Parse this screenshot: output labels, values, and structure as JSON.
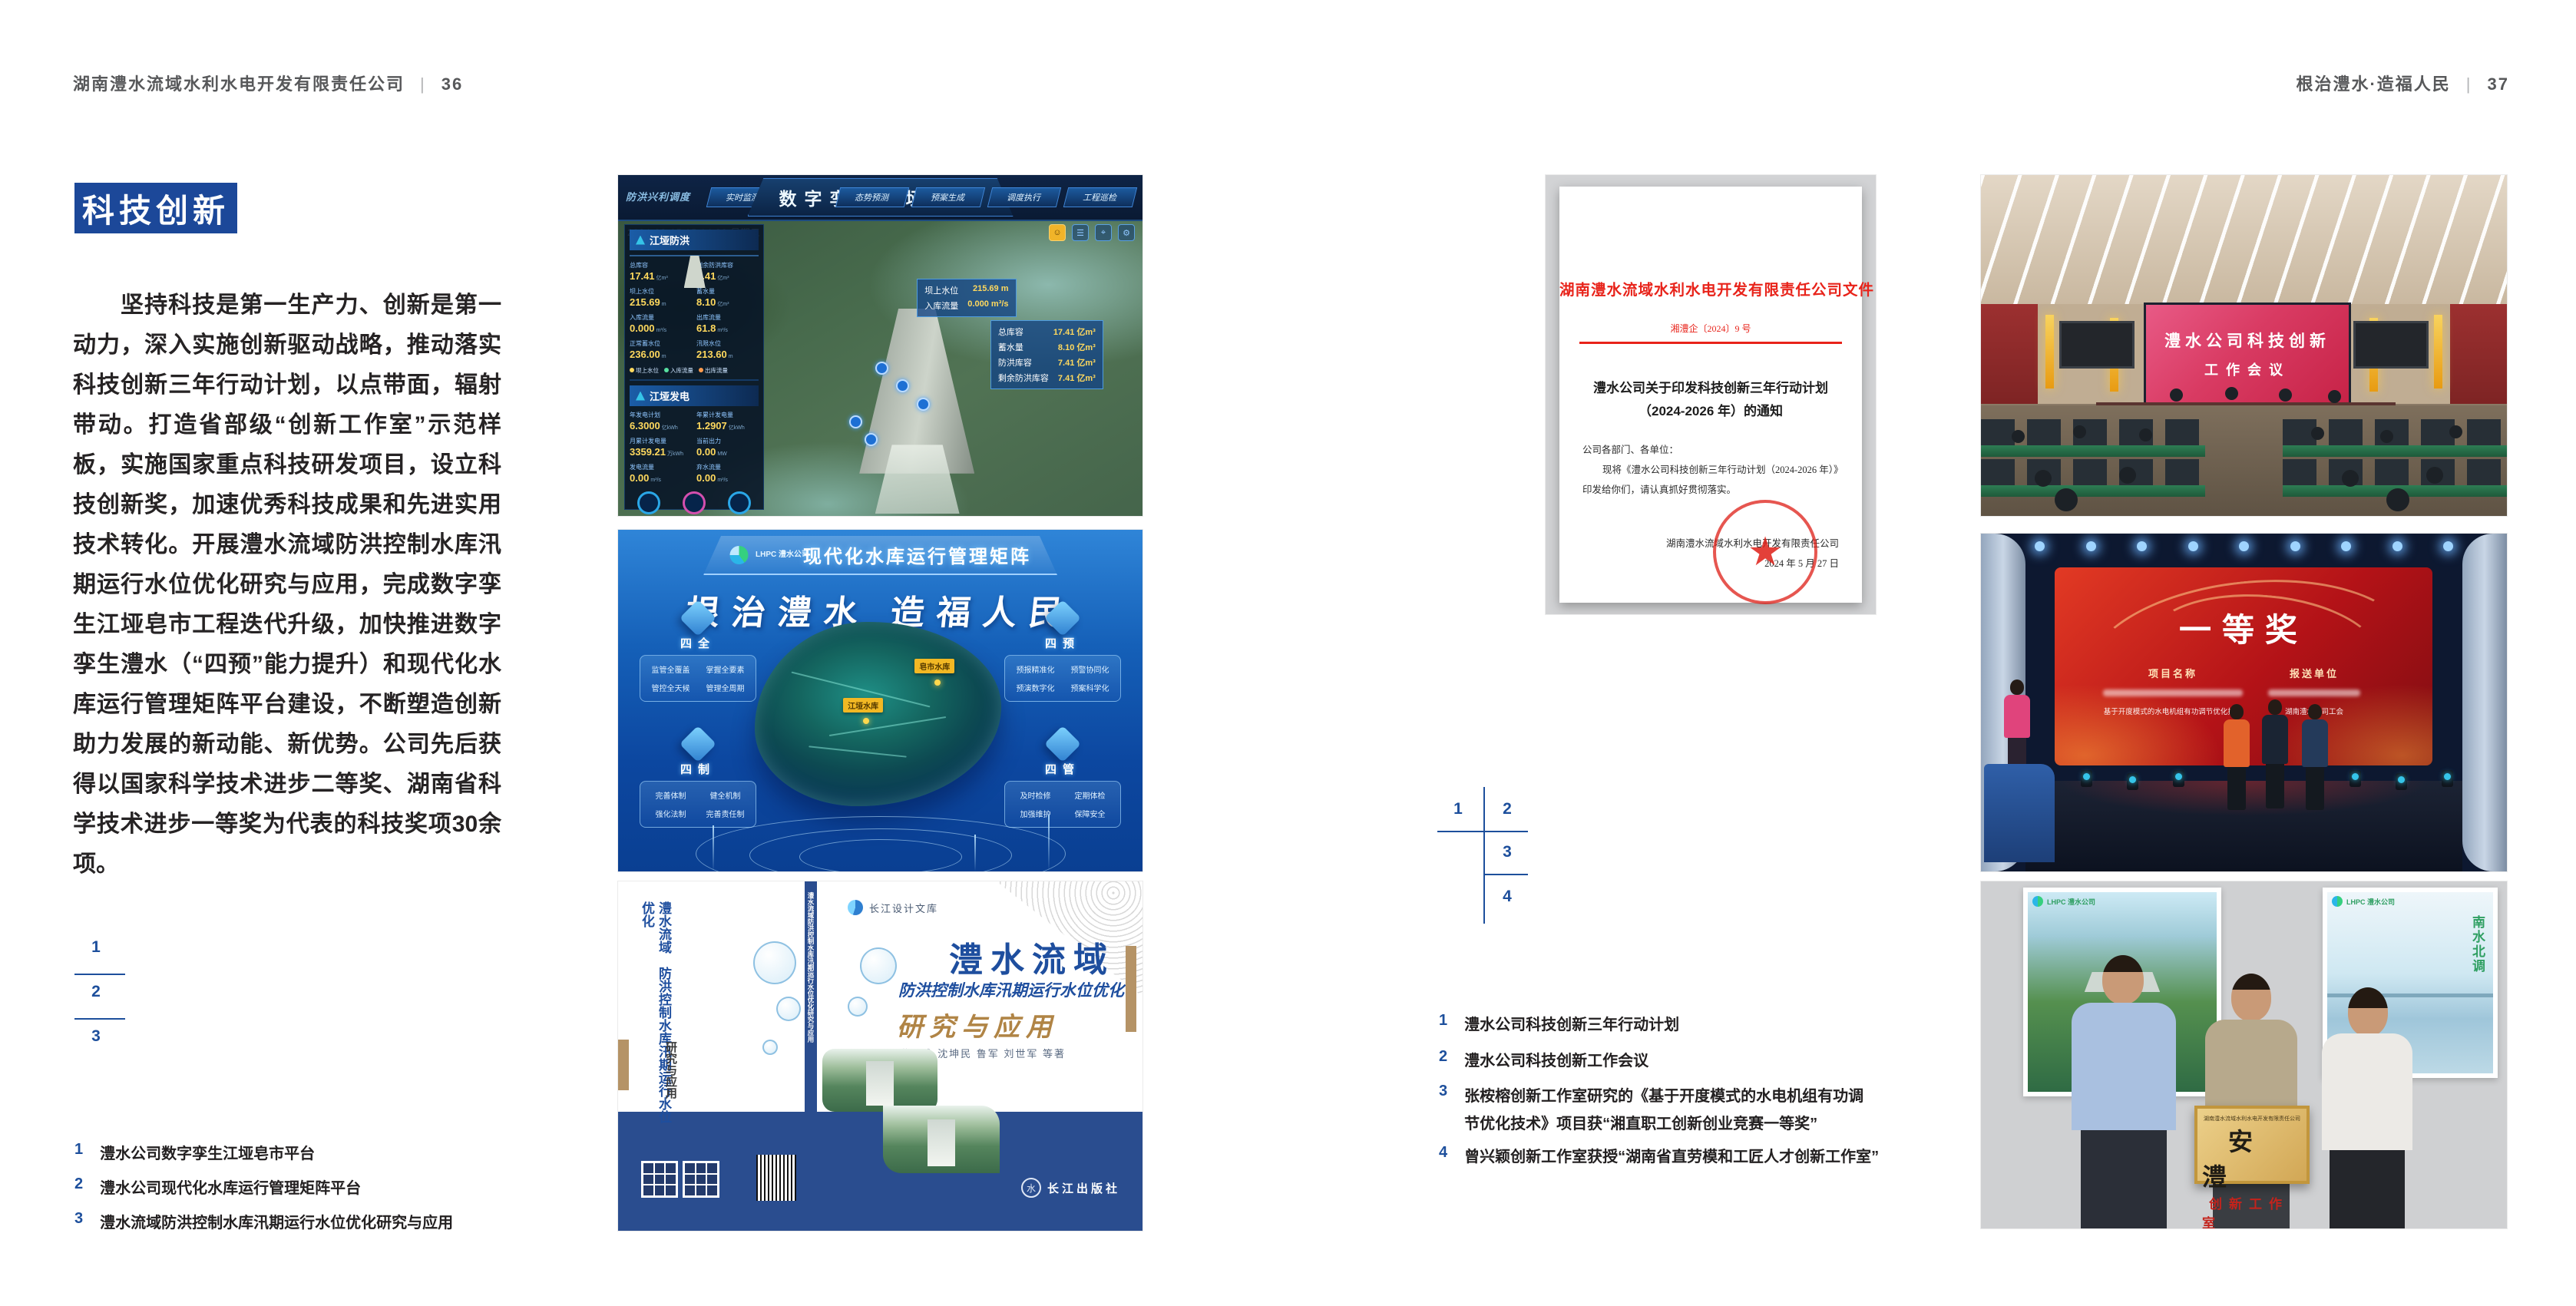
{
  "page_left": {
    "header": {
      "company": "湖南澧水流域水利水电开发有限责任公司",
      "divider": "|",
      "page_no": "36"
    },
    "section_title": "科技创新",
    "paragraph": "坚持科技是第一生产力、创新是第一动力，深入实施创新驱动战略，推动落实科技创新三年行动计划，以点带面，辐射带动。打造省部级“创新工作室”示范样板，实施国家重点科技研发项目，设立科技创新奖，加速优秀科技成果和先进实用技术转化。开展澧水流域防洪控制水库汛期运行水位优化研究与应用，完成数字孪生江垭皂市工程迭代升级，加快推进数字孪生澧水（“四预”能力提升）和现代化水库运行管理矩阵平台建设，不断塑造创新助力发展的新动能、新优势。公司先后获得以国家科学技术进步二等奖、湖南省科学技术进步一等奖为代表的科技奖项30余项。",
    "figure_index": [
      "1",
      "2",
      "3"
    ],
    "captions": [
      {
        "num": "1",
        "text": "澧水公司数字孪生江垭皂市平台"
      },
      {
        "num": "2",
        "text": "澧水公司现代化水库运行管理矩阵平台"
      },
      {
        "num": "3",
        "text": "澧水流域防洪控制水库汛期运行水位优化研究与应用"
      }
    ]
  },
  "dashboard": {
    "title": "数字孪生江垭皂市",
    "mode_label": "防洪兴利调度",
    "tabs_left": [
      "实时监测",
      "洪水预报",
      "防洪预警"
    ],
    "tabs_right": [
      "态势预测",
      "预案生成",
      "调度执行",
      "工程巡检"
    ],
    "timestamp": "2024-03-15 15:14:38 星期五",
    "flood": {
      "title": "江垭防洪",
      "stats": [
        {
          "label": "总库容",
          "value": "17.41",
          "unit": "亿m³"
        },
        {
          "label": "剩余防洪库容",
          "value": "7.41",
          "unit": "亿m³"
        },
        {
          "label": "坝上水位",
          "value": "215.69",
          "unit": "m"
        },
        {
          "label": "蓄水量",
          "value": "8.10",
          "unit": "亿m³"
        },
        {
          "label": "入库流量",
          "value": "0.000",
          "unit": "m³/s"
        },
        {
          "label": "出库流量",
          "value": "61.8",
          "unit": "m³/s"
        },
        {
          "label": "正常蓄水位",
          "value": "236.00",
          "unit": "m"
        },
        {
          "label": "汛限水位",
          "value": "213.60",
          "unit": "m"
        }
      ],
      "legend": [
        "坝上水位",
        "入库流量",
        "出库流量"
      ]
    },
    "power": {
      "title": "江垭发电",
      "stats": [
        {
          "label": "年发电计划",
          "value": "6.3000",
          "unit": "亿kWh"
        },
        {
          "label": "年累计发电量",
          "value": "1.2907",
          "unit": "亿kWh"
        },
        {
          "label": "月累计发电量",
          "value": "3359.21",
          "unit": "万kWh"
        },
        {
          "label": "当前出力",
          "value": "0.00",
          "unit": "MW"
        },
        {
          "label": "发电流量",
          "value": "0.00",
          "unit": "m³/s"
        },
        {
          "label": "弃水流量",
          "value": "0.00",
          "unit": "m³/s"
        }
      ]
    },
    "chip_dam": {
      "rows": [
        {
          "l": "坝上水位",
          "v": "215.69 m"
        },
        {
          "l": "入库流量",
          "v": "0.000 m³/s"
        }
      ]
    },
    "chip_storage": {
      "rows": [
        {
          "l": "总库容",
          "v": "17.41 亿m³"
        },
        {
          "l": "蓄水量",
          "v": "8.10 亿m³"
        },
        {
          "l": "防洪库容",
          "v": "7.41 亿m³"
        },
        {
          "l": "剩余防洪库容",
          "v": "7.41 亿m³"
        }
      ]
    }
  },
  "platform": {
    "brand": "LHPC 澧水公司",
    "title": "现代化水库运行管理矩阵",
    "slogan": "根治澧水 造福人民",
    "panels": [
      {
        "title": "四全",
        "items": [
          "监管全覆盖",
          "掌握全要素",
          "管控全天候",
          "管理全周期"
        ]
      },
      {
        "title": "四预",
        "items": [
          "预报精准化",
          "预警协同化",
          "预演数字化",
          "预案科学化"
        ]
      },
      {
        "title": "四制",
        "items": [
          "完善体制",
          "健全机制",
          "强化法制",
          "完善责任制"
        ]
      },
      {
        "title": "四管",
        "items": [
          "及时检修",
          "定期体检",
          "加强维护",
          "保障安全"
        ]
      }
    ],
    "map_labels": [
      "江垭水库",
      "皂市水库"
    ]
  },
  "book": {
    "series": "长江设计文库",
    "title_main": "澧水流域",
    "title_sub": "防洪控制水库汛期运行水位优化",
    "title_tail": "研究与应用",
    "authors": "洪兴骏 沈坤民 鲁军 刘世军 等著",
    "publisher": "长江出版社",
    "spine_title": "澧水流域防洪控制水库汛期运行水位优化研究与应用",
    "back_line1": "澧水流域",
    "back_line2": "防洪控制水库汛期运行水位优化",
    "back_line3": "研究与应用"
  },
  "page_right": {
    "header": {
      "slogan": "根治澧水·造福人民",
      "divider": "|",
      "page_no": "37"
    },
    "figure_index": [
      "1",
      "2",
      "3",
      "4"
    ],
    "captions": [
      {
        "num": "1",
        "text": "澧水公司科技创新三年行动计划"
      },
      {
        "num": "2",
        "text": "澧水公司科技创新工作会议"
      },
      {
        "num": "3",
        "text": "张桉榕创新工作室研究的《基于开度模式的水电机组有功调节优化技术》项目获“湘直职工创新创业竞赛一等奖”"
      },
      {
        "num": "4",
        "text": "曾兴颖创新工作室获授“湖南省直劳模和工匠人才创新工作室”"
      }
    ]
  },
  "document": {
    "org_banner": "湖南澧水流域水利水电开发有限责任公司文件",
    "doc_no": "湘澧企〔2024〕9 号",
    "title_line1": "澧水公司关于印发科技创新三年行动计划",
    "title_line2": "（2024-2026 年）的通知",
    "salutation": "公司各部门、各单位：",
    "body": "现将《澧水公司科技创新三年行动计划（2024-2026 年）》印发给你们，请认真抓好贯彻落实。",
    "signer": "湖南澧水流域水利水电开发有限责任公司",
    "date": "2024 年 5 月 27 日"
  },
  "meeting": {
    "screen_line1": "澧水公司科技创新",
    "screen_line2": "工作会议"
  },
  "award": {
    "title": "一等奖",
    "col_project": "项目名称",
    "col_unit": "报送单位",
    "project_2": "基于开度模式的水电机组有功调节优化技术",
    "unit_2": "湖南澧水公司工会"
  },
  "group_photo": {
    "poster_logo": "LHPC 澧水公司",
    "poster_right_text": "南水北调",
    "plaque_org": "湖南澧水流域水利水电开发有限责任公司",
    "plaque_name": "安澧",
    "plaque_sub": "创新工作室"
  }
}
